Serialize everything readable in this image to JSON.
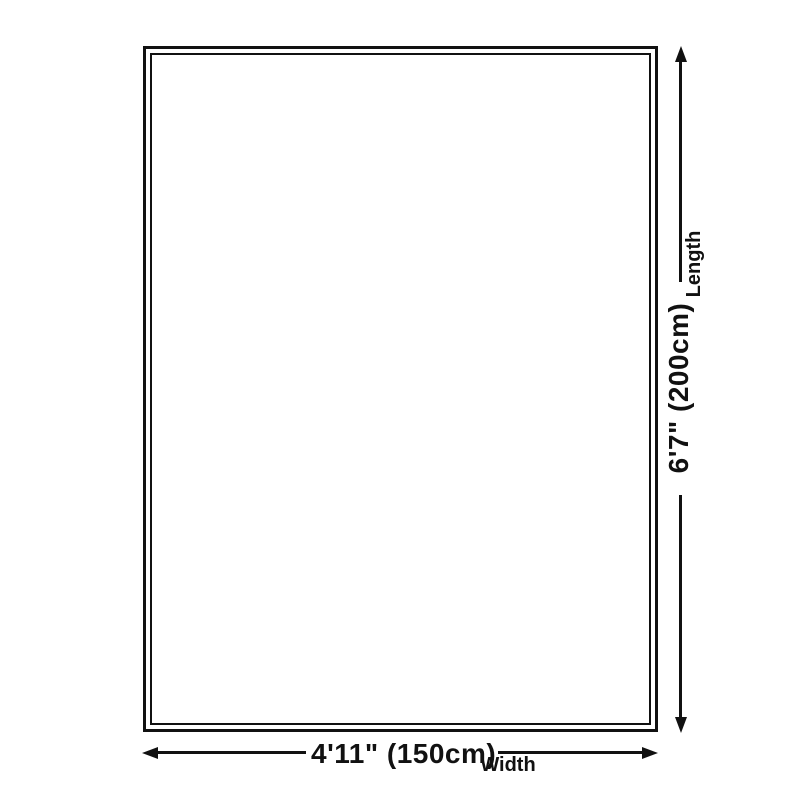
{
  "diagram": {
    "length_dimension": {
      "value": "6'7\" (200cm)",
      "axis_label": "Length"
    },
    "width_dimension": {
      "value": "4'11\" (150cm)",
      "axis_label": "Width"
    },
    "colors": {
      "ink": "#111111",
      "background": "#ffffff"
    }
  }
}
